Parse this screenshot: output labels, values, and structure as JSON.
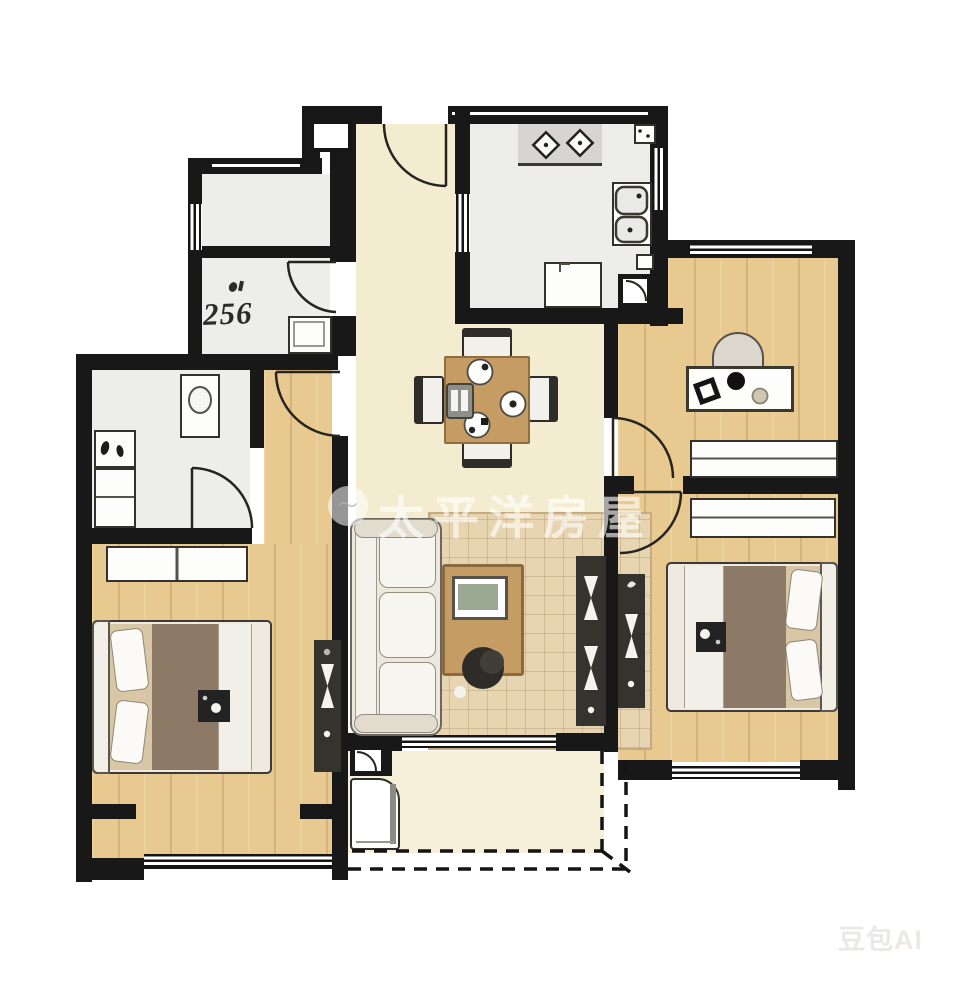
{
  "labels": {
    "wc_area": "256"
  },
  "watermarks": {
    "center_logo_glyph": "〜",
    "center_text": "太平洋房屋",
    "bottom_right_text": "豆包AI"
  },
  "palette": {
    "wall": "#181818",
    "hall_floor": "#f4ecd1",
    "wood_floor": "#e8c98f",
    "tile_floor": "#ededeb",
    "balcony_floor": "#f6f0db",
    "dark_furniture": "#35332e",
    "duvet_brown": "#8d7a66",
    "table_wood": "#c49c64",
    "rug": "#e6d5b0"
  }
}
